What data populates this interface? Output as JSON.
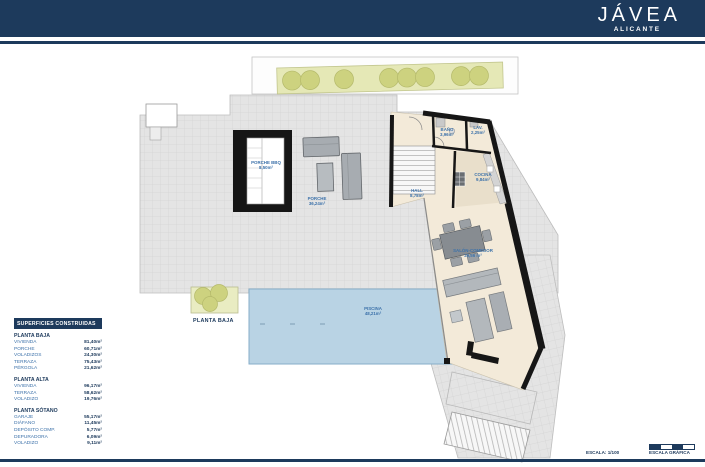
{
  "header": {
    "title": "JÁVEA",
    "subtitle": "ALICANTE"
  },
  "legend": {
    "title": "SUPERFICIES CONSTRUIDAS",
    "sections": [
      {
        "title": "PLANTA BAJA",
        "rows": [
          {
            "label": "VIVIENDA",
            "value": "81,40m²"
          },
          {
            "label": "PORCHE",
            "value": "60,71m²"
          },
          {
            "label": "VOLADIZOS",
            "value": "24,30m²"
          },
          {
            "label": "TERRAZA",
            "value": "75,43m²"
          },
          {
            "label": "PÉRGOLA",
            "value": "21,62m²"
          }
        ]
      },
      {
        "title": "PLANTA ALTA",
        "rows": [
          {
            "label": "VIVIENDA",
            "value": "96,17m²"
          },
          {
            "label": "TERRAZA",
            "value": "58,62m²"
          },
          {
            "label": "VOLADIZO",
            "value": "19,76m²"
          }
        ]
      },
      {
        "title": "PLANTA SÓTANO",
        "rows": [
          {
            "label": "GARAJE",
            "value": "55,17m²"
          },
          {
            "label": "DIÁFANO",
            "value": "11,45m²"
          },
          {
            "label": "DEPÓSITO COMP.",
            "value": "5,77m²"
          },
          {
            "label": "DEPURADORA",
            "value": "6,09m²"
          },
          {
            "label": "VOLADIZO",
            "value": "9,11m²"
          }
        ]
      }
    ]
  },
  "plan": {
    "floor_label": "PLANTA BAJA",
    "rooms": [
      {
        "name": "PORCHE BBQ",
        "area": "8,50m²"
      },
      {
        "name": "PORCHE",
        "area": "36,24m²"
      },
      {
        "name": "BAÑO",
        "area": "3,96m²"
      },
      {
        "name": "LAV.",
        "area": "2,25m²"
      },
      {
        "name": "COCINA",
        "area": "9,84m²"
      },
      {
        "name": "HALL",
        "area": "8,78m²"
      },
      {
        "name": "SALÓN-COMEDOR",
        "area": "29,56 m²"
      },
      {
        "name": "PISCINA",
        "area": "48,21m²"
      }
    ]
  },
  "footer": {
    "scale_label": "ESCALA:  1/100",
    "graphic_scale_label": "ESCALA GRÁFICA"
  },
  "colors": {
    "navy": "#1d3a5c",
    "label-blue": "#3d72aa",
    "pool-blue": "#b9d3e4",
    "planter-green": "#e5e8b6",
    "planter-circle": "#cdd27f",
    "terrace-gray": "#e4e4e4",
    "floor-cream": "#f3ead9",
    "wall-black": "#161616"
  }
}
